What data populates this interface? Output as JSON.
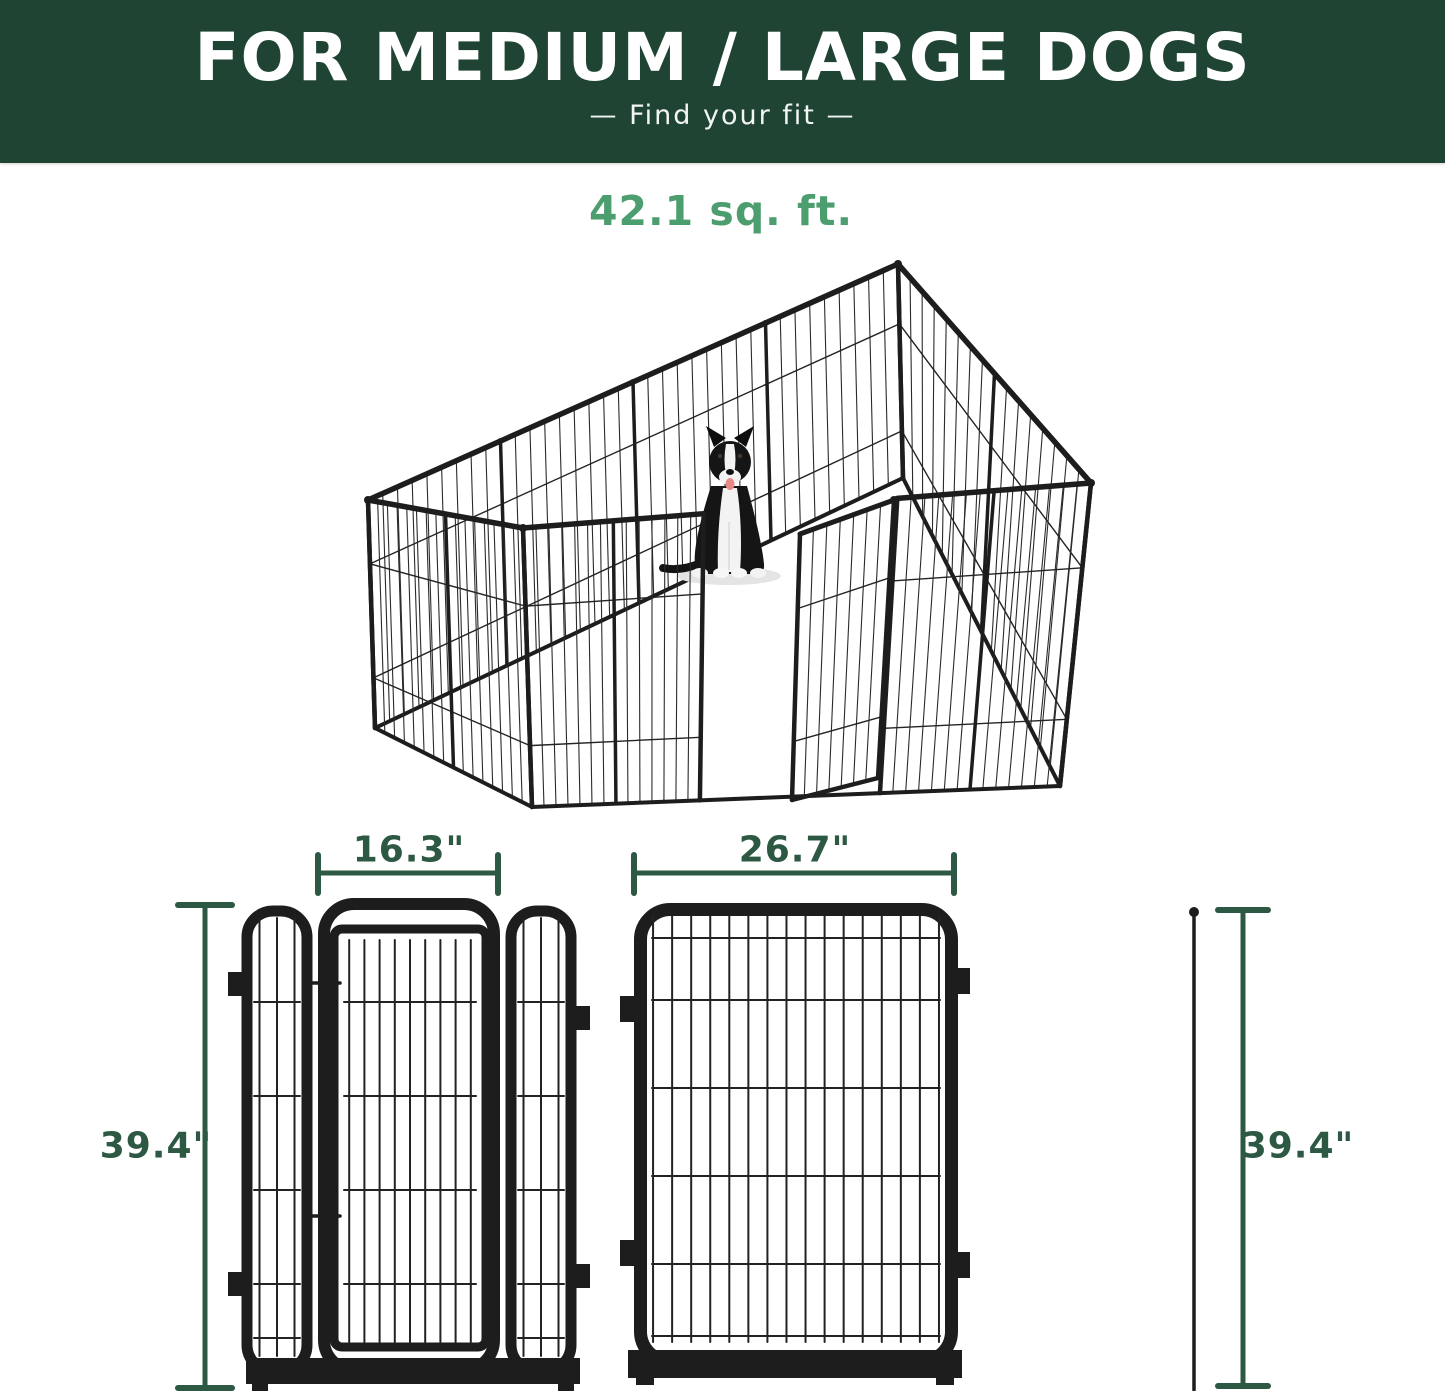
{
  "header": {
    "title": "FOR MEDIUM / LARGE DOGS",
    "subtitle": "—  Find your fit  —"
  },
  "area": {
    "label": "42.1 sq. ft."
  },
  "dims": {
    "gate_width": "16.3\"",
    "panel_width": "26.7\"",
    "height_left": "39.4\"",
    "height_right": "39.4\""
  },
  "illustration": {
    "subject": "12-panel metal dog playpen with open gate and sitting border collie",
    "panels_visible": 12
  },
  "colors": {
    "header_bg": "#1F4433",
    "header_text": "#FFFFFF",
    "area_green": "#4C9E6E",
    "dimension_green": "#2D5843",
    "metal_black": "#1D1D1D",
    "background": "#FFFFFF"
  }
}
